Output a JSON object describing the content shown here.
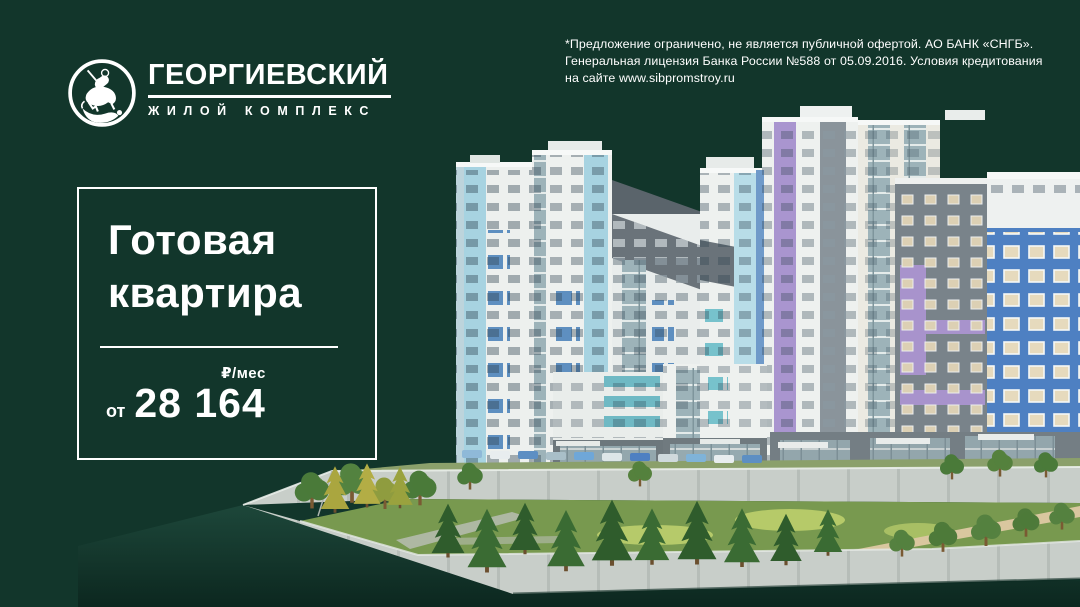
{
  "logo": {
    "title": "ГЕОРГИЕВСКИЙ",
    "subtitle": "ЖИЛОЙ КОМПЛЕКС",
    "emblem": "st-george-horseman-emblem"
  },
  "disclaimer": {
    "line1": "*Предложение ограничено, не является публичной офертой. АО БАНК «СНГБ».",
    "line2": "Генеральная лицензия Банка России №588 от 05.09.2016. Условия кредитования",
    "line3": "на сайте www.sibpromstroy.ru"
  },
  "offer": {
    "title_line1": "Готовая",
    "title_line2": "квартира",
    "per_month_label": "₽/мес",
    "from_label": "от",
    "price": "28 164"
  },
  "illustration": {
    "alt": "3D render of Georgievsky residential complex on a waterfront embankment"
  },
  "colors": {
    "background": "#12362b",
    "text": "#ffffff",
    "facade_white": "#eef1ef",
    "facade_light_blue": "#a7d3e1",
    "facade_steel_blue": "#5e8fc0",
    "facade_teal": "#77c2cc",
    "facade_lavender": "#a995cf",
    "facade_blue_building": "#4e80c2",
    "facade_gray": "#79838a",
    "concrete": "#c8cec9",
    "lawn": "#78994f",
    "water": "#16392d"
  }
}
